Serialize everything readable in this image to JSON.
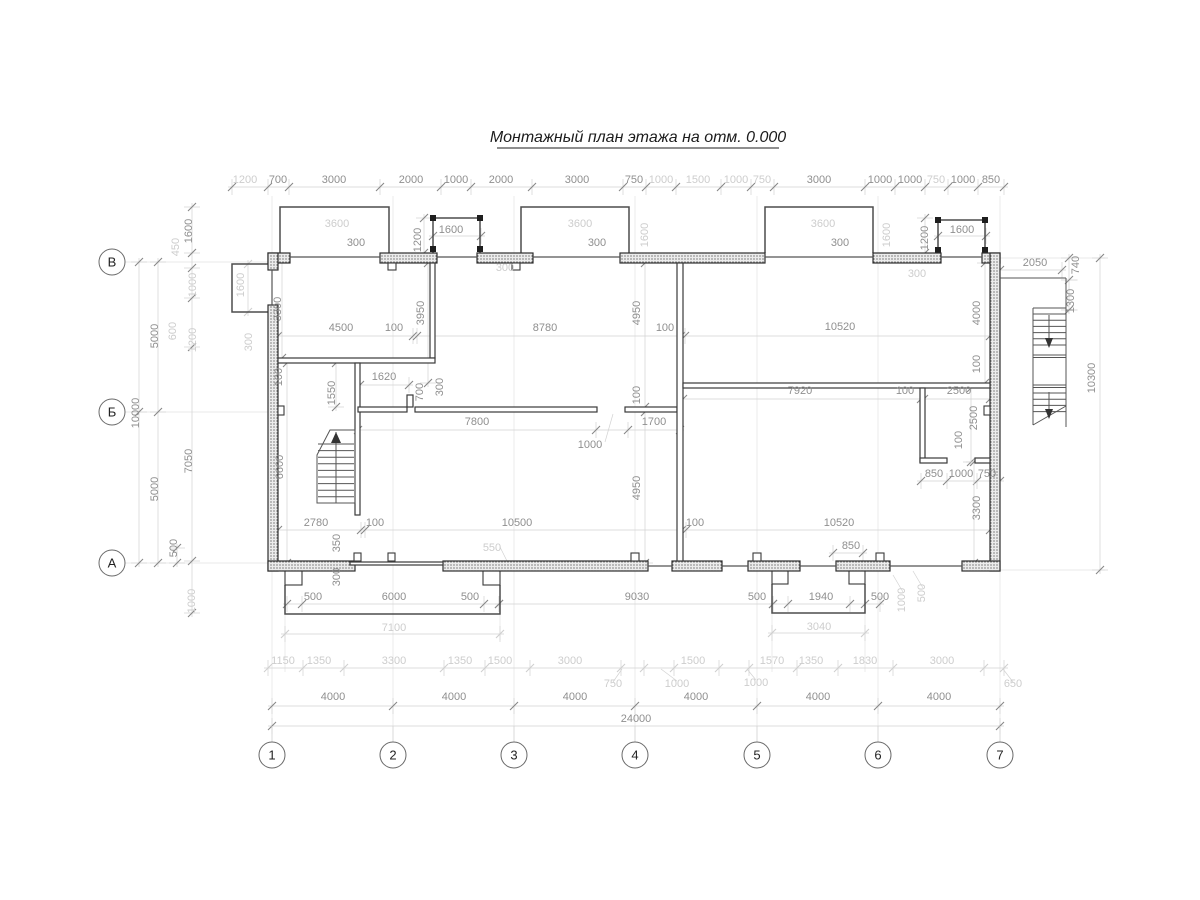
{
  "title": "Монтажный план этажа на отм. 0.000",
  "colors": {
    "dim_dark": "#8f8f8f",
    "dim_light": "#cdcdcd",
    "wall_line": "#2e2e2e",
    "title_color": "#1c1c1c"
  },
  "axes": {
    "columns": [
      {
        "label": "1",
        "x": 272
      },
      {
        "label": "2",
        "x": 393
      },
      {
        "label": "3",
        "x": 514
      },
      {
        "label": "4",
        "x": 635
      },
      {
        "label": "5",
        "x": 757
      },
      {
        "label": "6",
        "x": 878
      },
      {
        "label": "7",
        "x": 1000
      }
    ],
    "columns_y": 755,
    "rows": [
      {
        "label": "В",
        "y": 262
      },
      {
        "label": "Б",
        "y": 412
      },
      {
        "label": "А",
        "y": 563
      }
    ],
    "rows_x": 112
  },
  "dimension_labels": [
    {
      "t": "1200",
      "x": 245,
      "y": 183,
      "r": 0,
      "lt": true
    },
    {
      "t": "700",
      "x": 278,
      "y": 183,
      "r": 0,
      "lt": false
    },
    {
      "t": "3000",
      "x": 334,
      "y": 183,
      "r": 0,
      "lt": false
    },
    {
      "t": "2000",
      "x": 411,
      "y": 183,
      "r": 0,
      "lt": false
    },
    {
      "t": "1000",
      "x": 456,
      "y": 183,
      "r": 0,
      "lt": false
    },
    {
      "t": "2000",
      "x": 501,
      "y": 183,
      "r": 0,
      "lt": false
    },
    {
      "t": "3000",
      "x": 577,
      "y": 183,
      "r": 0,
      "lt": false
    },
    {
      "t": "750",
      "x": 634,
      "y": 183,
      "r": 0,
      "lt": false
    },
    {
      "t": "1000",
      "x": 661,
      "y": 183,
      "r": 0,
      "lt": true
    },
    {
      "t": "1500",
      "x": 698,
      "y": 183,
      "r": 0,
      "lt": true
    },
    {
      "t": "1000",
      "x": 736,
      "y": 183,
      "r": 0,
      "lt": true
    },
    {
      "t": "750",
      "x": 762,
      "y": 183,
      "r": 0,
      "lt": true
    },
    {
      "t": "3000",
      "x": 819,
      "y": 183,
      "r": 0,
      "lt": false
    },
    {
      "t": "1000",
      "x": 880,
      "y": 183,
      "r": 0,
      "lt": false
    },
    {
      "t": "1000",
      "x": 910,
      "y": 183,
      "r": 0,
      "lt": false
    },
    {
      "t": "750",
      "x": 936,
      "y": 183,
      "r": 0,
      "lt": true
    },
    {
      "t": "1000",
      "x": 963,
      "y": 183,
      "r": 0,
      "lt": false
    },
    {
      "t": "850",
      "x": 991,
      "y": 183,
      "r": 0,
      "lt": false
    },
    {
      "t": "3600",
      "x": 337,
      "y": 227,
      "r": 0,
      "lt": true
    },
    {
      "t": "300",
      "x": 356,
      "y": 246,
      "r": 0,
      "lt": false
    },
    {
      "t": "1600",
      "x": 451,
      "y": 233,
      "r": 0,
      "lt": false
    },
    {
      "t": "1200",
      "x": 421,
      "y": 240,
      "r": 90,
      "lt": false
    },
    {
      "t": "3600",
      "x": 580,
      "y": 227,
      "r": 0,
      "lt": true
    },
    {
      "t": "300",
      "x": 597,
      "y": 246,
      "r": 0,
      "lt": false
    },
    {
      "t": "1600",
      "x": 648,
      "y": 235,
      "r": 90,
      "lt": true
    },
    {
      "t": "300",
      "x": 505,
      "y": 271,
      "r": 0,
      "lt": true
    },
    {
      "t": "3600",
      "x": 823,
      "y": 227,
      "r": 0,
      "lt": true
    },
    {
      "t": "300",
      "x": 840,
      "y": 246,
      "r": 0,
      "lt": false
    },
    {
      "t": "1600",
      "x": 890,
      "y": 235,
      "r": 90,
      "lt": true
    },
    {
      "t": "1600",
      "x": 962,
      "y": 233,
      "r": 0,
      "lt": false
    },
    {
      "t": "1200",
      "x": 928,
      "y": 238,
      "r": 90,
      "lt": false
    },
    {
      "t": "300",
      "x": 917,
      "y": 277,
      "r": 0,
      "lt": true
    },
    {
      "t": "1600",
      "x": 192,
      "y": 231,
      "r": 90,
      "lt": false
    },
    {
      "t": "450",
      "x": 179,
      "y": 247,
      "r": 90,
      "lt": true
    },
    {
      "t": "1000",
      "x": 196,
      "y": 285,
      "r": 90,
      "lt": true
    },
    {
      "t": "600",
      "x": 176,
      "y": 331,
      "r": 90,
      "lt": true
    },
    {
      "t": "1200",
      "x": 196,
      "y": 340,
      "r": 90,
      "lt": true
    },
    {
      "t": "5000",
      "x": 158,
      "y": 336,
      "r": 90,
      "lt": false
    },
    {
      "t": "10000",
      "x": 139,
      "y": 413,
      "r": 90,
      "lt": false
    },
    {
      "t": "7050",
      "x": 192,
      "y": 461,
      "r": 90,
      "lt": false
    },
    {
      "t": "5000",
      "x": 158,
      "y": 489,
      "r": 90,
      "lt": false
    },
    {
      "t": "500",
      "x": 177,
      "y": 548,
      "r": 90,
      "lt": false
    },
    {
      "t": "1000",
      "x": 195,
      "y": 601,
      "r": 90,
      "lt": true
    },
    {
      "t": "1600",
      "x": 244,
      "y": 285,
      "r": 90,
      "lt": true
    },
    {
      "t": "3300",
      "x": 281,
      "y": 309,
      "r": 90,
      "lt": false
    },
    {
      "t": "300",
      "x": 252,
      "y": 342,
      "r": 90,
      "lt": true
    },
    {
      "t": "4500",
      "x": 341,
      "y": 331,
      "r": 0,
      "lt": false
    },
    {
      "t": "100",
      "x": 394,
      "y": 331,
      "r": 0,
      "lt": false
    },
    {
      "t": "8780",
      "x": 545,
      "y": 331,
      "r": 0,
      "lt": false
    },
    {
      "t": "100",
      "x": 665,
      "y": 331,
      "r": 0,
      "lt": false
    },
    {
      "t": "10520",
      "x": 840,
      "y": 330,
      "r": 0,
      "lt": false
    },
    {
      "t": "3950",
      "x": 424,
      "y": 313,
      "r": 90,
      "lt": false
    },
    {
      "t": "4950",
      "x": 640,
      "y": 313,
      "r": 90,
      "lt": false
    },
    {
      "t": "4000",
      "x": 980,
      "y": 313,
      "r": 90,
      "lt": false
    },
    {
      "t": "100",
      "x": 980,
      "y": 364,
      "r": 90,
      "lt": false
    },
    {
      "t": "100",
      "x": 282,
      "y": 377,
      "r": 90,
      "lt": false
    },
    {
      "t": "1550",
      "x": 335,
      "y": 393,
      "r": 90,
      "lt": false
    },
    {
      "t": "1620",
      "x": 384,
      "y": 380,
      "r": 0,
      "lt": false
    },
    {
      "t": "700",
      "x": 423,
      "y": 392,
      "r": 90,
      "lt": false
    },
    {
      "t": "300",
      "x": 443,
      "y": 387,
      "r": 90,
      "lt": false
    },
    {
      "t": "7800",
      "x": 477,
      "y": 425,
      "r": 0,
      "lt": false
    },
    {
      "t": "100",
      "x": 640,
      "y": 395,
      "r": 90,
      "lt": false
    },
    {
      "t": "1700",
      "x": 654,
      "y": 425,
      "r": 0,
      "lt": false
    },
    {
      "t": "1000",
      "x": 590,
      "y": 448,
      "r": 0,
      "lt": false
    },
    {
      "t": "7920",
      "x": 800,
      "y": 394,
      "r": 0,
      "lt": false
    },
    {
      "t": "100",
      "x": 905,
      "y": 394,
      "r": 0,
      "lt": false
    },
    {
      "t": "2500",
      "x": 959,
      "y": 394,
      "r": 0,
      "lt": false
    },
    {
      "t": "2500",
      "x": 977,
      "y": 418,
      "r": 90,
      "lt": false
    },
    {
      "t": "100",
      "x": 962,
      "y": 440,
      "r": 90,
      "lt": false
    },
    {
      "t": "6600",
      "x": 283,
      "y": 467,
      "r": 90,
      "lt": false
    },
    {
      "t": "4950",
      "x": 640,
      "y": 488,
      "r": 90,
      "lt": false
    },
    {
      "t": "850",
      "x": 934,
      "y": 477,
      "r": 0,
      "lt": false
    },
    {
      "t": "1000",
      "x": 961,
      "y": 477,
      "r": 0,
      "lt": false
    },
    {
      "t": "750",
      "x": 987,
      "y": 477,
      "r": 0,
      "lt": false
    },
    {
      "t": "3300",
      "x": 980,
      "y": 508,
      "r": 90,
      "lt": false
    },
    {
      "t": "2050",
      "x": 1035,
      "y": 266,
      "r": 0,
      "lt": false
    },
    {
      "t": "740",
      "x": 1079,
      "y": 265,
      "r": 90,
      "lt": false
    },
    {
      "t": "1300",
      "x": 1074,
      "y": 301,
      "r": 90,
      "lt": false
    },
    {
      "t": "10300",
      "x": 1095,
      "y": 378,
      "r": 90,
      "lt": false
    },
    {
      "t": "2780",
      "x": 316,
      "y": 526,
      "r": 0,
      "lt": false
    },
    {
      "t": "100",
      "x": 375,
      "y": 526,
      "r": 0,
      "lt": false
    },
    {
      "t": "10500",
      "x": 517,
      "y": 526,
      "r": 0,
      "lt": false
    },
    {
      "t": "100",
      "x": 695,
      "y": 526,
      "r": 0,
      "lt": false
    },
    {
      "t": "10520",
      "x": 839,
      "y": 526,
      "r": 0,
      "lt": false
    },
    {
      "t": "350",
      "x": 340,
      "y": 543,
      "r": 90,
      "lt": false
    },
    {
      "t": "300",
      "x": 340,
      "y": 577,
      "r": 90,
      "lt": false
    },
    {
      "t": "550",
      "x": 492,
      "y": 551,
      "r": 0,
      "lt": true
    },
    {
      "t": "850",
      "x": 851,
      "y": 549,
      "r": 0,
      "lt": false
    },
    {
      "t": "500",
      "x": 313,
      "y": 600,
      "r": 0,
      "lt": false
    },
    {
      "t": "6000",
      "x": 394,
      "y": 600,
      "r": 0,
      "lt": false
    },
    {
      "t": "500",
      "x": 470,
      "y": 600,
      "r": 0,
      "lt": false
    },
    {
      "t": "7100",
      "x": 394,
      "y": 631,
      "r": 0,
      "lt": true
    },
    {
      "t": "9030",
      "x": 637,
      "y": 600,
      "r": 0,
      "lt": false
    },
    {
      "t": "500",
      "x": 757,
      "y": 600,
      "r": 0,
      "lt": false
    },
    {
      "t": "1940",
      "x": 821,
      "y": 600,
      "r": 0,
      "lt": false
    },
    {
      "t": "500",
      "x": 880,
      "y": 600,
      "r": 0,
      "lt": false
    },
    {
      "t": "3040",
      "x": 819,
      "y": 630,
      "r": 0,
      "lt": true
    },
    {
      "t": "1000",
      "x": 905,
      "y": 600,
      "r": 90,
      "lt": true
    },
    {
      "t": "500",
      "x": 925,
      "y": 593,
      "r": 90,
      "lt": true
    },
    {
      "t": "1150",
      "x": 283,
      "y": 664,
      "r": 0,
      "lt": true
    },
    {
      "t": "1350",
      "x": 319,
      "y": 664,
      "r": 0,
      "lt": true
    },
    {
      "t": "3300",
      "x": 394,
      "y": 664,
      "r": 0,
      "lt": true
    },
    {
      "t": "1350",
      "x": 460,
      "y": 664,
      "r": 0,
      "lt": true
    },
    {
      "t": "1500",
      "x": 500,
      "y": 664,
      "r": 0,
      "lt": true
    },
    {
      "t": "3000",
      "x": 570,
      "y": 664,
      "r": 0,
      "lt": true
    },
    {
      "t": "1500",
      "x": 693,
      "y": 664,
      "r": 0,
      "lt": true
    },
    {
      "t": "750",
      "x": 613,
      "y": 687,
      "r": 0,
      "lt": true
    },
    {
      "t": "1000",
      "x": 677,
      "y": 687,
      "r": 0,
      "lt": true
    },
    {
      "t": "1000",
      "x": 756,
      "y": 686,
      "r": 0,
      "lt": true
    },
    {
      "t": "1570",
      "x": 772,
      "y": 664,
      "r": 0,
      "lt": true
    },
    {
      "t": "1350",
      "x": 811,
      "y": 664,
      "r": 0,
      "lt": true
    },
    {
      "t": "1830",
      "x": 865,
      "y": 664,
      "r": 0,
      "lt": true
    },
    {
      "t": "3000",
      "x": 942,
      "y": 664,
      "r": 0,
      "lt": true
    },
    {
      "t": "650",
      "x": 1013,
      "y": 687,
      "r": 0,
      "lt": true
    },
    {
      "t": "4000",
      "x": 333,
      "y": 700,
      "r": 0,
      "lt": false
    },
    {
      "t": "4000",
      "x": 454,
      "y": 700,
      "r": 0,
      "lt": false
    },
    {
      "t": "4000",
      "x": 575,
      "y": 700,
      "r": 0,
      "lt": false
    },
    {
      "t": "4000",
      "x": 696,
      "y": 700,
      "r": 0,
      "lt": false
    },
    {
      "t": "4000",
      "x": 818,
      "y": 700,
      "r": 0,
      "lt": false
    },
    {
      "t": "4000",
      "x": 939,
      "y": 700,
      "r": 0,
      "lt": false
    },
    {
      "t": "24000",
      "x": 636,
      "y": 722,
      "r": 0,
      "lt": false
    }
  ]
}
